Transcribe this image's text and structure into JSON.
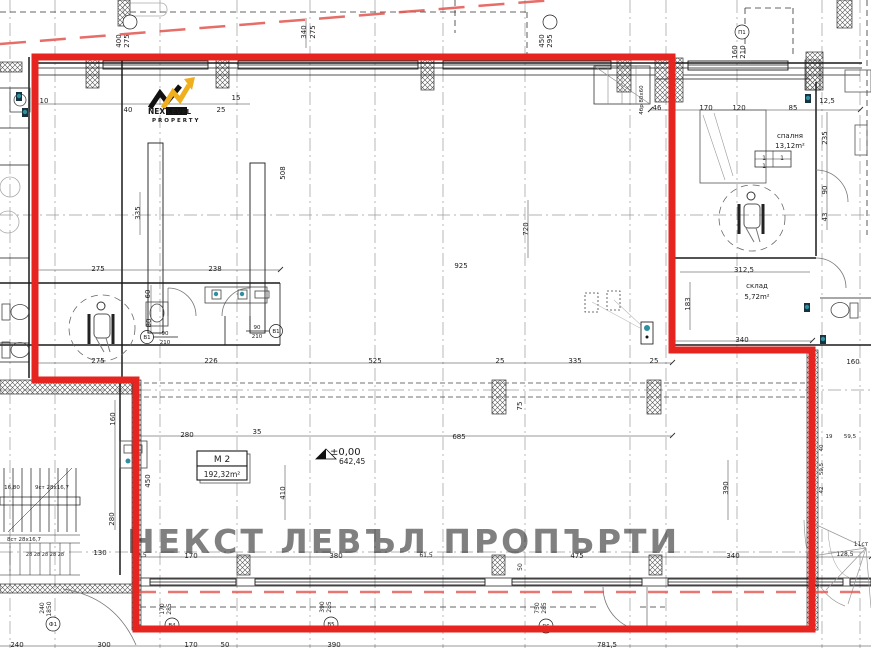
{
  "watermark": "НЕКСТ ЛЕВЪЛ ПРОПЪРТИ",
  "logo": {
    "name_black": "NEXT",
    "name_chip": "LEVEL",
    "subtitle": "PROPERTY"
  },
  "unit_box": {
    "id": "М 2",
    "area": "192,32m²"
  },
  "level_marker": {
    "relative": "±0,00",
    "absolute": "642,45"
  },
  "rooms": [
    {
      "name": "спалня",
      "area": "13,12m²"
    },
    {
      "name": "склад",
      "area": "5,72m²"
    }
  ],
  "closet_note": "4бр 80х60",
  "door_tags": [
    {
      "id": "В1",
      "w": "90",
      "h": "210"
    },
    {
      "id": "В1",
      "w": "90",
      "h": "210"
    }
  ],
  "opening_tags": [
    {
      "id": ""
    },
    {
      "id": ""
    },
    {
      "id": "П1"
    },
    {
      "id": "Ф1"
    },
    {
      "id": "В4"
    },
    {
      "id": "В5"
    },
    {
      "id": "В6"
    }
  ],
  "colors": {
    "outline_red": "#e62520",
    "dashed_red": "#e2544e",
    "watermark_pink": "#d95f68",
    "logo_yellow": "#f0af1f",
    "fixture_teal": "#2e8fa0"
  },
  "annotations": [
    {
      "t": "10",
      "x": 44,
      "y": 103
    },
    {
      "t": "40",
      "x": 128,
      "y": 112
    },
    {
      "t": "15",
      "x": 236,
      "y": 100
    },
    {
      "t": "25",
      "x": 221,
      "y": 112
    },
    {
      "t": "340",
      "x": 306,
      "y": 32,
      "r": 1
    },
    {
      "t": "275",
      "x": 315,
      "y": 32,
      "r": 1
    },
    {
      "t": "400",
      "x": 121,
      "y": 41,
      "r": 1
    },
    {
      "t": "275",
      "x": 129,
      "y": 41,
      "r": 1
    },
    {
      "t": "450",
      "x": 544,
      "y": 41,
      "r": 1
    },
    {
      "t": "295",
      "x": 552,
      "y": 41,
      "r": 1
    },
    {
      "t": "160",
      "x": 737,
      "y": 52,
      "r": 1
    },
    {
      "t": "210",
      "x": 745,
      "y": 52,
      "r": 1
    },
    {
      "t": "46",
      "x": 657,
      "y": 110
    },
    {
      "t": "170",
      "x": 706,
      "y": 110
    },
    {
      "t": "120",
      "x": 739,
      "y": 110
    },
    {
      "t": "85",
      "x": 793,
      "y": 110
    },
    {
      "t": "12,5",
      "x": 827,
      "y": 103
    },
    {
      "t": "235",
      "x": 827,
      "y": 138,
      "r": 1
    },
    {
      "t": "90",
      "x": 827,
      "y": 190,
      "r": 1
    },
    {
      "t": "43",
      "x": 827,
      "y": 217,
      "r": 1
    },
    {
      "t": "335",
      "x": 140,
      "y": 213,
      "r": 1
    },
    {
      "t": "508",
      "x": 285,
      "y": 173,
      "r": 1
    },
    {
      "t": "720",
      "x": 528,
      "y": 229,
      "r": 1
    },
    {
      "t": "183",
      "x": 690,
      "y": 304,
      "r": 1
    },
    {
      "t": "275",
      "x": 98,
      "y": 271
    },
    {
      "t": "238",
      "x": 215,
      "y": 271
    },
    {
      "t": "925",
      "x": 461,
      "y": 268
    },
    {
      "t": "312,5",
      "x": 744,
      "y": 272
    },
    {
      "t": "60",
      "x": 150,
      "y": 294,
      "r": 1
    },
    {
      "t": "80",
      "x": 151,
      "y": 323,
      "r": 1
    },
    {
      "t": "275",
      "x": 98,
      "y": 363
    },
    {
      "t": "226",
      "x": 211,
      "y": 363
    },
    {
      "t": "525",
      "x": 375,
      "y": 363
    },
    {
      "t": "25",
      "x": 500,
      "y": 363
    },
    {
      "t": "335",
      "x": 575,
      "y": 363
    },
    {
      "t": "25",
      "x": 654,
      "y": 363
    },
    {
      "t": "160",
      "x": 853,
      "y": 364
    },
    {
      "t": "340",
      "x": 742,
      "y": 342
    },
    {
      "t": "75",
      "x": 522,
      "y": 406,
      "r": 1
    },
    {
      "t": "280",
      "x": 187,
      "y": 437
    },
    {
      "t": "35",
      "x": 257,
      "y": 434
    },
    {
      "t": "685",
      "x": 459,
      "y": 439
    },
    {
      "t": "410",
      "x": 285,
      "y": 493,
      "r": 1
    },
    {
      "t": "390",
      "x": 728,
      "y": 488,
      "r": 1
    },
    {
      "t": "450",
      "x": 150,
      "y": 481,
      "r": 1
    },
    {
      "t": "160",
      "x": 115,
      "y": 419,
      "r": 1
    },
    {
      "t": "280",
      "x": 114,
      "y": 519,
      "r": 1
    },
    {
      "t": "16,80",
      "x": 12,
      "y": 489,
      "s": 5.5
    },
    {
      "t": "9ст 28х16,7",
      "x": 52,
      "y": 489,
      "s": 5.5
    },
    {
      "t": "8ст 28х16,7",
      "x": 24,
      "y": 541,
      "s": 5.5
    },
    {
      "t": "28  28  28  28  28",
      "x": 45,
      "y": 556,
      "s": 5
    },
    {
      "t": "130",
      "x": 100,
      "y": 555
    },
    {
      "t": "42,5",
      "x": 140,
      "y": 557,
      "s": 6
    },
    {
      "t": "170",
      "x": 191,
      "y": 558
    },
    {
      "t": "380",
      "x": 336,
      "y": 558
    },
    {
      "t": "61,5",
      "x": 426,
      "y": 557,
      "s": 6
    },
    {
      "t": "50",
      "x": 522,
      "y": 567,
      "r": 1,
      "s": 6
    },
    {
      "t": "475",
      "x": 577,
      "y": 558
    },
    {
      "t": "340",
      "x": 733,
      "y": 558
    },
    {
      "t": "128,5",
      "x": 845,
      "y": 556,
      "s": 6
    },
    {
      "t": "11ст",
      "x": 861,
      "y": 546,
      "s": 6
    },
    {
      "t": "59,5",
      "x": 850,
      "y": 438,
      "s": 5.5
    },
    {
      "t": "19",
      "x": 829,
      "y": 438,
      "s": 5.5
    },
    {
      "t": "40",
      "x": 823,
      "y": 448,
      "r": 1,
      "s": 5.5
    },
    {
      "t": "59,5",
      "x": 823,
      "y": 469,
      "r": 1,
      "s": 5.5
    },
    {
      "t": "42",
      "x": 823,
      "y": 490,
      "r": 1,
      "s": 5.5
    },
    {
      "t": "240",
      "x": 44,
      "y": 608,
      "r": 1,
      "s": 6
    },
    {
      "t": "1850",
      "x": 51,
      "y": 609,
      "r": 1,
      "s": 6
    },
    {
      "t": "170",
      "x": 164,
      "y": 609,
      "r": 1,
      "s": 6
    },
    {
      "t": "285",
      "x": 171,
      "y": 609,
      "r": 1,
      "s": 6
    },
    {
      "t": "390",
      "x": 324,
      "y": 607,
      "r": 1,
      "s": 6
    },
    {
      "t": "285",
      "x": 331,
      "y": 607,
      "r": 1,
      "s": 6
    },
    {
      "t": "750",
      "x": 539,
      "y": 608,
      "r": 1,
      "s": 6
    },
    {
      "t": "285",
      "x": 546,
      "y": 608,
      "r": 1,
      "s": 6
    },
    {
      "t": "240",
      "x": 17,
      "y": 647
    },
    {
      "t": "300",
      "x": 104,
      "y": 647
    },
    {
      "t": "170",
      "x": 191,
      "y": 647
    },
    {
      "t": "50",
      "x": 225,
      "y": 647
    },
    {
      "t": "390",
      "x": 334,
      "y": 647
    },
    {
      "t": "781,5",
      "x": 607,
      "y": 647
    },
    {
      "t": "1",
      "x": 764,
      "y": 160,
      "s": 6
    },
    {
      "t": "1",
      "x": 782,
      "y": 160,
      "s": 6
    },
    {
      "t": "1",
      "x": 764,
      "y": 168,
      "s": 6
    }
  ]
}
